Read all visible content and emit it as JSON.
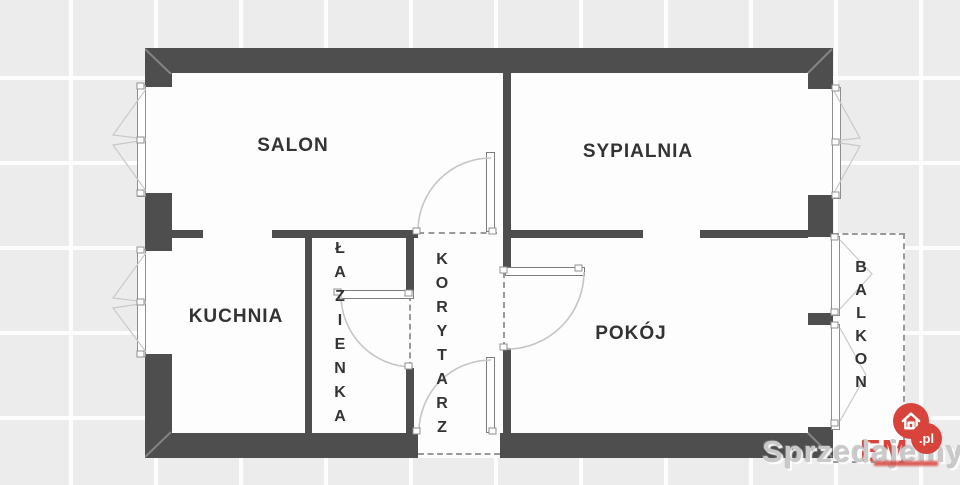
{
  "plan": {
    "rooms": {
      "salon": {
        "label": "SALON"
      },
      "sypialnia": {
        "label": "SYPIALNIA"
      },
      "kuchnia": {
        "label": "KUCHNIA"
      },
      "lazienka": {
        "label": "ŁAZIENKA"
      },
      "korytarz": {
        "label": "KORYTARZ"
      },
      "pokoj": {
        "label": "POKÓJ"
      },
      "balkon": {
        "label": "BALKON"
      }
    },
    "colors": {
      "wall": "#4e4e4e",
      "room_fill": "#fdfdfd",
      "background": "#ececec",
      "door_arc": "#c5c5c5",
      "dashed_line": "#9a9a9a",
      "label_text": "#333333"
    }
  },
  "watermark": {
    "text": "Sprzedajemy",
    "color": "#c9c9c9"
  },
  "logo": {
    "name": "EM",
    "tld": ".pl",
    "accent_color": "#d8433c",
    "icon": "house-icon"
  }
}
